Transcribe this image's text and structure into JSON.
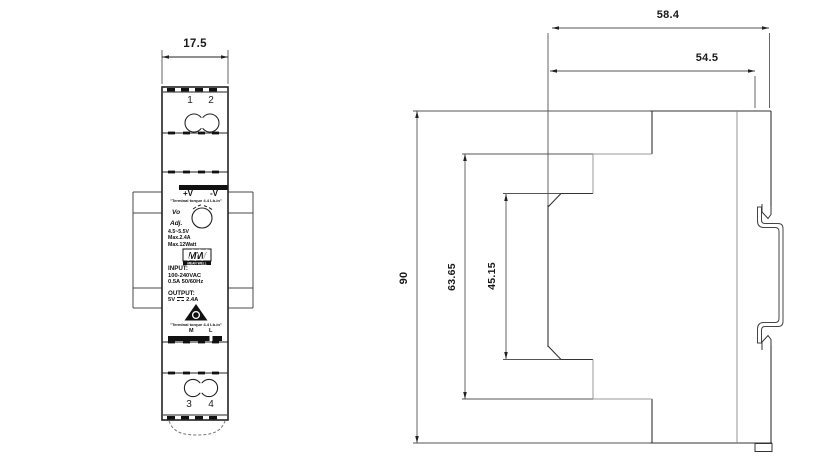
{
  "title": "DIN rail power supply mechanical drawing",
  "front_view": {
    "width_dim": "17.5",
    "terminals_top": [
      "1",
      "2"
    ],
    "terminals_bottom": [
      "3",
      "4"
    ],
    "label": {
      "out_pos": "+V",
      "out_neg": "-V",
      "torque_note_top": "\"Terminal torque 4.4 Lb-in\"",
      "vo": "Vo",
      "adj": "Adj.",
      "adjust_range": "4.5~5.5V",
      "max_current": "Max.2.4A",
      "max_power": "Max.12Watt",
      "brand": "MW",
      "brand_name": "MEAN WELL",
      "input_heading": "INPUT:",
      "input_voltage": "100-240VAC",
      "input_current_freq": "0.5A  50/60Hz",
      "output_heading": "OUTPUT:",
      "output_volt": "5V",
      "output_amp": "2.4A",
      "torque_note_bottom": "\"Terminal torque 4.4 Lb-in\"",
      "cert_mark_left": "M",
      "cert_mark_right": "L"
    }
  },
  "side_view": {
    "overall_depth": "58.4",
    "body_depth": "54.5",
    "height": "90",
    "mid_section_height": "63.65",
    "front_section_height": "45.15"
  },
  "colors": {
    "line_dark": "#2a2a2a",
    "line_light": "#999999",
    "fill_black": "#111111",
    "background": "#ffffff"
  }
}
